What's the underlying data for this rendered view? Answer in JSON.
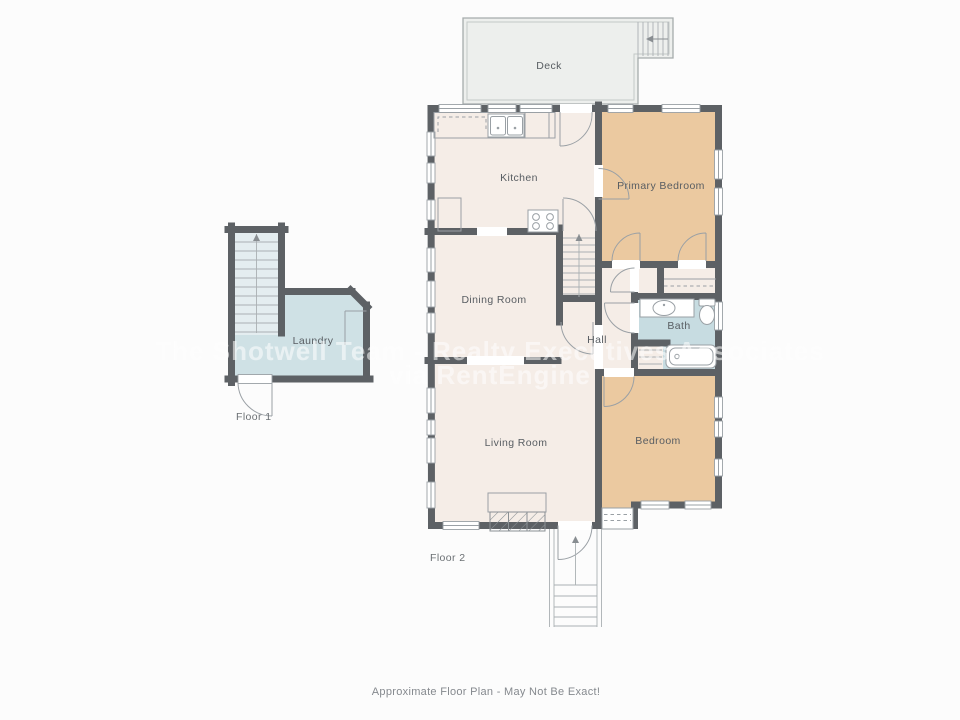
{
  "caption": "Approximate Floor Plan - May Not Be Exact!",
  "watermark": {
    "line1": "The Shotwell Team - Realty Executives Associates",
    "line2": "via RentEngine"
  },
  "floor1": {
    "label": "Floor 1",
    "rooms": {
      "laundry": "Laundry"
    }
  },
  "floor2": {
    "label": "Floor 2",
    "rooms": {
      "deck": "Deck",
      "kitchen": "Kitchen",
      "primary_bedroom": "Primary Bedroom",
      "dining_room": "Dining Room",
      "hall": "Hall",
      "bath": "Bath",
      "living_room": "Living Room",
      "bedroom": "Bedroom"
    }
  },
  "colors": {
    "wall": "#5d6165",
    "floor": "#f5ede7",
    "bedroom": "#ebc9a0",
    "bath": "#c7dce1",
    "laundry": "#cfe1e5",
    "stairs_fill": "#e4edf0",
    "deck": "#edefed",
    "fixture_line": "#9aa0a5",
    "label_text": "#585d62",
    "watermark": "#ffffff"
  }
}
